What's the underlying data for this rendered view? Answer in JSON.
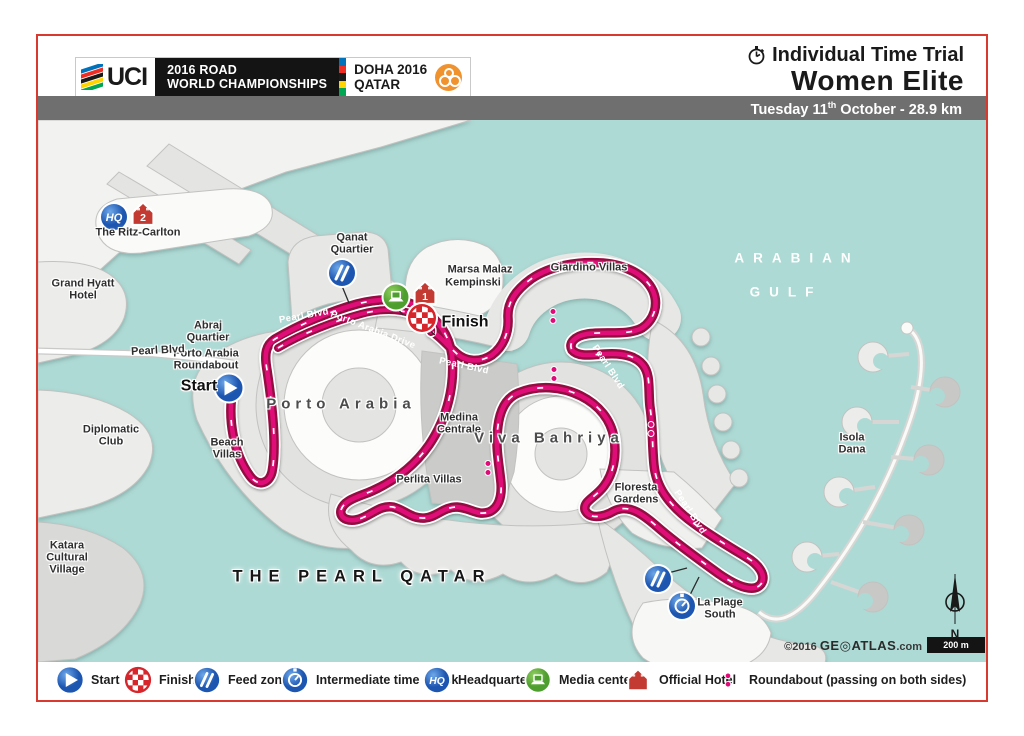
{
  "header": {
    "uci": "UCI",
    "champ_line1": "2016 ROAD",
    "champ_line2": "WORLD CHAMPIONSHIPS",
    "doha_line1": "DOHA 2016",
    "doha_line2": "QATAR",
    "event_line1": "Individual Time Trial",
    "event_line2": "Women Elite",
    "date_pre": "Tuesday 11",
    "date_sup": "th",
    "date_post": " October - 28.9 km"
  },
  "map": {
    "compass_n": "N",
    "scale_label": "200 m",
    "credits_copy": "©2016",
    "credits_brand": "GE◎ATLAS",
    "credits_tld": ".com",
    "icon_text": {
      "hq": "HQ"
    },
    "labels": [
      {
        "t": "The Ritz-Carlton",
        "x": 138,
        "y": 233
      },
      {
        "t": "Grand Hyatt",
        "x": 83,
        "y": 284
      },
      {
        "t": "Hotel",
        "x": 83,
        "y": 296
      },
      {
        "t": "Qanat",
        "x": 352,
        "y": 238
      },
      {
        "t": "Quartier",
        "x": 352,
        "y": 250
      },
      {
        "t": "Marsa Malaz",
        "x": 480,
        "y": 270
      },
      {
        "t": "Kempinski",
        "x": 473,
        "y": 283
      },
      {
        "t": "Giardino Villas",
        "x": 589,
        "y": 268
      },
      {
        "t": "Abraj",
        "x": 208,
        "y": 326
      },
      {
        "t": "Quartier",
        "x": 208,
        "y": 338
      },
      {
        "t": "Porto Arabia",
        "x": 206,
        "y": 354
      },
      {
        "t": "Roundabout",
        "x": 206,
        "y": 366
      },
      {
        "t": "Start",
        "x": 199,
        "y": 386,
        "cls": "lg"
      },
      {
        "t": "Finish",
        "x": 465,
        "y": 322,
        "cls": "lg"
      },
      {
        "t": "Beach",
        "x": 227,
        "y": 443
      },
      {
        "t": "Villas",
        "x": 227,
        "y": 455
      },
      {
        "t": "Diplomatic",
        "x": 111,
        "y": 430
      },
      {
        "t": "Club",
        "x": 111,
        "y": 442
      },
      {
        "t": "Katara",
        "x": 67,
        "y": 546
      },
      {
        "t": "Cultural",
        "x": 67,
        "y": 558
      },
      {
        "t": "Village",
        "x": 67,
        "y": 570
      },
      {
        "t": "Medina",
        "x": 459,
        "y": 418
      },
      {
        "t": "Centrale",
        "x": 459,
        "y": 430
      },
      {
        "t": "Perlita Villas",
        "x": 429,
        "y": 480
      },
      {
        "t": "Floresta",
        "x": 636,
        "y": 488
      },
      {
        "t": "Gardens",
        "x": 636,
        "y": 500
      },
      {
        "t": "La Plage",
        "x": 720,
        "y": 603
      },
      {
        "t": "South",
        "x": 720,
        "y": 615
      },
      {
        "t": "Isola",
        "x": 852,
        "y": 438
      },
      {
        "t": "Dana",
        "x": 852,
        "y": 450
      },
      {
        "t": "Pearl Blvd",
        "x": 158,
        "y": 351,
        "r": -3
      },
      {
        "t": "Porto Arabia",
        "x": 341,
        "y": 404,
        "cls": "big"
      },
      {
        "t": "Viva Bahriya",
        "x": 549,
        "y": 438,
        "cls": "big"
      },
      {
        "t": "THE PEARL QATAR",
        "x": 362,
        "y": 577,
        "cls": "big2"
      },
      {
        "t": "ARABIAN",
        "x": 797,
        "y": 258,
        "cls": "sea"
      },
      {
        "t": "GULF",
        "x": 786,
        "y": 292,
        "cls": "sea"
      }
    ],
    "route_labels": [
      {
        "t": "Pearl Blvd",
        "x": 304,
        "y": 316,
        "r": -10
      },
      {
        "t": "Porto Arabia Drive",
        "x": 373,
        "y": 330,
        "r": 21
      },
      {
        "t": "Pearl Blvd",
        "x": 464,
        "y": 366,
        "r": 12
      },
      {
        "t": "Pearl Blvd",
        "x": 608,
        "y": 367,
        "r": 57
      },
      {
        "t": "Pearl Blvd",
        "x": 690,
        "y": 512,
        "r": 57
      }
    ],
    "icons": [
      {
        "type": "hq",
        "x": 113,
        "y": 215
      },
      {
        "type": "hotel",
        "n": "2",
        "x": 142,
        "y": 212
      },
      {
        "type": "start",
        "x": 228,
        "y": 386
      },
      {
        "type": "feed",
        "x": 341,
        "y": 271
      },
      {
        "type": "media",
        "x": 395,
        "y": 295
      },
      {
        "type": "hotel",
        "n": "1",
        "x": 424,
        "y": 291
      },
      {
        "type": "finish",
        "x": 421,
        "y": 316
      },
      {
        "type": "feed",
        "x": 657,
        "y": 577
      },
      {
        "type": "timecheck",
        "x": 681,
        "y": 604
      }
    ],
    "stems": [
      [
        341,
        284,
        348,
        301
      ],
      [
        396,
        306,
        402,
        313
      ],
      [
        427,
        327,
        434,
        333
      ],
      [
        667,
        571,
        686,
        566
      ],
      [
        688,
        595,
        698,
        575
      ]
    ],
    "roundabouts": [
      [
        552,
        314
      ],
      [
        553,
        372
      ],
      [
        650,
        427
      ],
      [
        487,
        466
      ]
    ]
  },
  "legend": {
    "items": [
      {
        "type": "start",
        "label": "Start",
        "x": 70
      },
      {
        "type": "finish",
        "label": "Finish",
        "x": 138
      },
      {
        "type": "feed",
        "label": "Feed zone",
        "x": 207
      },
      {
        "type": "timecheck",
        "label": "Intermediate time check",
        "x": 295
      },
      {
        "type": "hq",
        "label": "Headquarters",
        "x": 437
      },
      {
        "type": "media",
        "label": "Media center",
        "x": 538
      },
      {
        "type": "hotel",
        "label": "Official Hotel",
        "x": 638
      },
      {
        "type": "rb",
        "label": "Roundabout (passing on both sides)",
        "x": 728
      }
    ]
  },
  "colors": {
    "water": "#aedad5",
    "route_magenta": "#e00a78",
    "route_crimson": "#921040",
    "frame_red": "#d93a30",
    "icon_blue": "#1d56b0",
    "icon_green": "#4e9e2f",
    "icon_red": "#c23a31"
  }
}
